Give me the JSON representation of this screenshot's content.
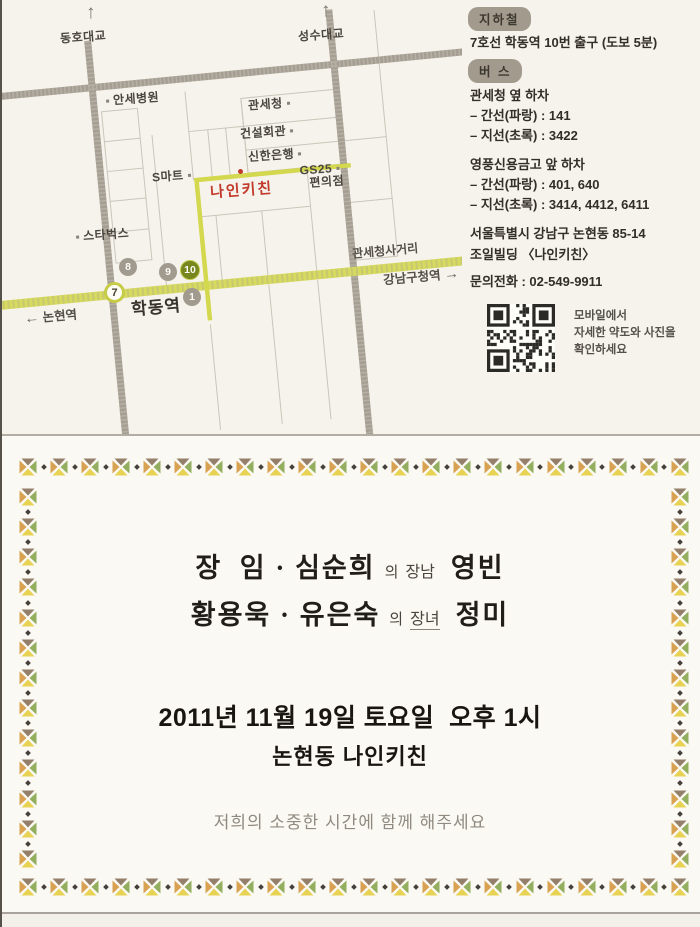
{
  "map": {
    "bridges": [
      {
        "label": "동호대교"
      },
      {
        "label": "성수대교"
      }
    ],
    "places": [
      {
        "name": "안세병원"
      },
      {
        "name": "관세청"
      },
      {
        "name": "건설회관"
      },
      {
        "name": "신한은행"
      },
      {
        "name": "S마트"
      },
      {
        "name": "GS25",
        "name2": "편의점"
      },
      {
        "name": "스타벅스"
      }
    ],
    "venue_label": "나인키친",
    "street_label": "관세청사거리",
    "station": {
      "line_badge": "7",
      "name": "학동역"
    },
    "direction_right": "강남구청역",
    "direction_left": "논현역",
    "exits": [
      {
        "n": "8"
      },
      {
        "n": "9"
      },
      {
        "n": "10"
      },
      {
        "n": "1"
      }
    ]
  },
  "info": {
    "subway": {
      "badge": "지하철",
      "line": "7호선 학동역 10번 출구 (도보 5분)"
    },
    "bus": {
      "badge": "버 스",
      "stops": [
        {
          "title": "관세청 옆 하차",
          "lines": [
            "– 간선(파랑) : 141",
            "– 지선(초록) : 3422"
          ]
        },
        {
          "title": "영풍신용금고 앞 하차",
          "lines": [
            "– 간선(파랑) : 401, 640",
            "– 지선(초록) : 3414, 4412, 6411"
          ]
        }
      ]
    },
    "address_line1": "서울특별시 강남구 논현동 85-14",
    "address_line2": "조일빌딩 〈나인키친〉",
    "phone": "문의전화 : 02-549-9911",
    "qr_caption": [
      "모바일에서",
      "자세한 약도와 사진을",
      "확인하세요"
    ]
  },
  "invitation": {
    "groom": {
      "parents": "장  임 · 심순희",
      "particle": "의",
      "relation": "장남",
      "name": "영빈"
    },
    "bride": {
      "parents": "황용욱 · 유은숙",
      "particle": "의",
      "relation": "장녀",
      "name": "정미"
    },
    "datetime": "2011년 11월 19일 토요일  오후 1시",
    "venue": "논현동 나인키친",
    "message": "저희의 소중한 시간에 함께 해주세요"
  },
  "colors": {
    "route_yellow": "#d6da5f",
    "venue_red": "#c23a2c",
    "road_gray": "#a59e93",
    "badge_bg": "#a29a8d",
    "exit_highlight": "#77861d",
    "ornament_orange": "#d9a253",
    "ornament_green": "#93ae5e",
    "ornament_yellow": "#e7d254",
    "ornament_brown": "#94806a"
  }
}
